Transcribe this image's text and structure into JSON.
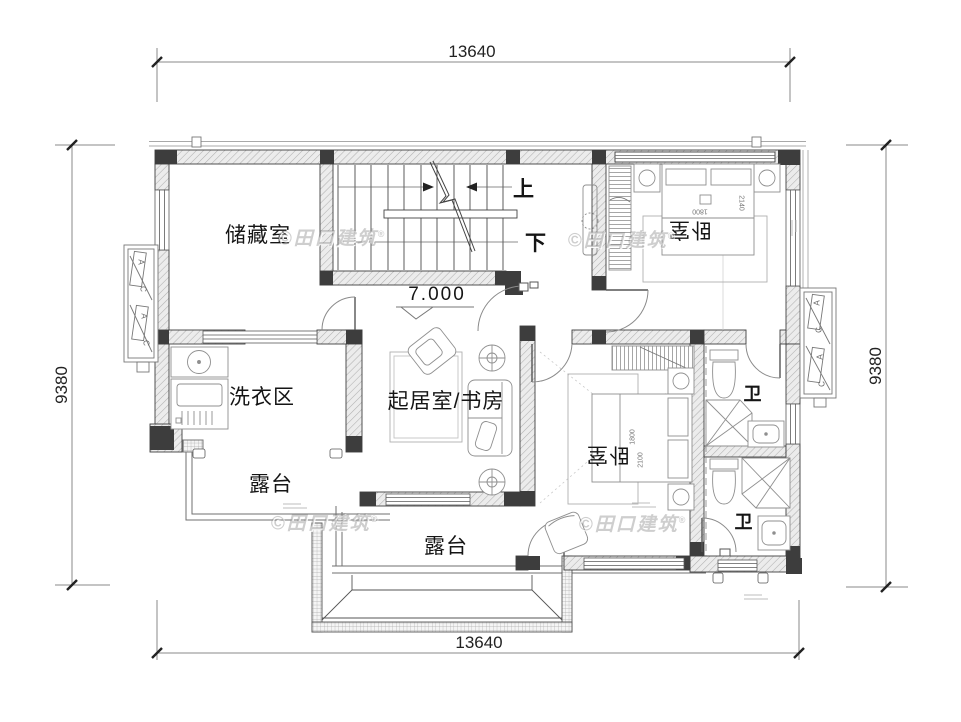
{
  "watermark": {
    "text": "©田口建筑",
    "registered": "®"
  },
  "dimensions": {
    "top": "13640",
    "bottom": "13640",
    "left": "9380",
    "right": "9380"
  },
  "level": {
    "value": "7.000"
  },
  "stairs": {
    "up": "上",
    "down": "下"
  },
  "rooms": {
    "storage": "储藏室",
    "bedroom_top": "卧室",
    "bedroom_mid": "卧室",
    "laundry": "洗衣区",
    "living_study": "起居室/书房",
    "bath_top": "卫",
    "bath_bottom": "卫",
    "terrace_left": "露台",
    "terrace_bottom": "露台"
  },
  "beds": {
    "top": {
      "width": "1800",
      "length": "2140"
    },
    "mid": {
      "width": "1800",
      "length": "2100"
    }
  },
  "ac": {
    "letters": [
      "A",
      "C",
      "A",
      "C"
    ]
  },
  "colors": {
    "wall_hatch": "#ececec",
    "wall_dark": "#3d3d3d",
    "line": "#444444",
    "furniture": "#8f8f8f",
    "watermark": "#c9c9c9"
  }
}
